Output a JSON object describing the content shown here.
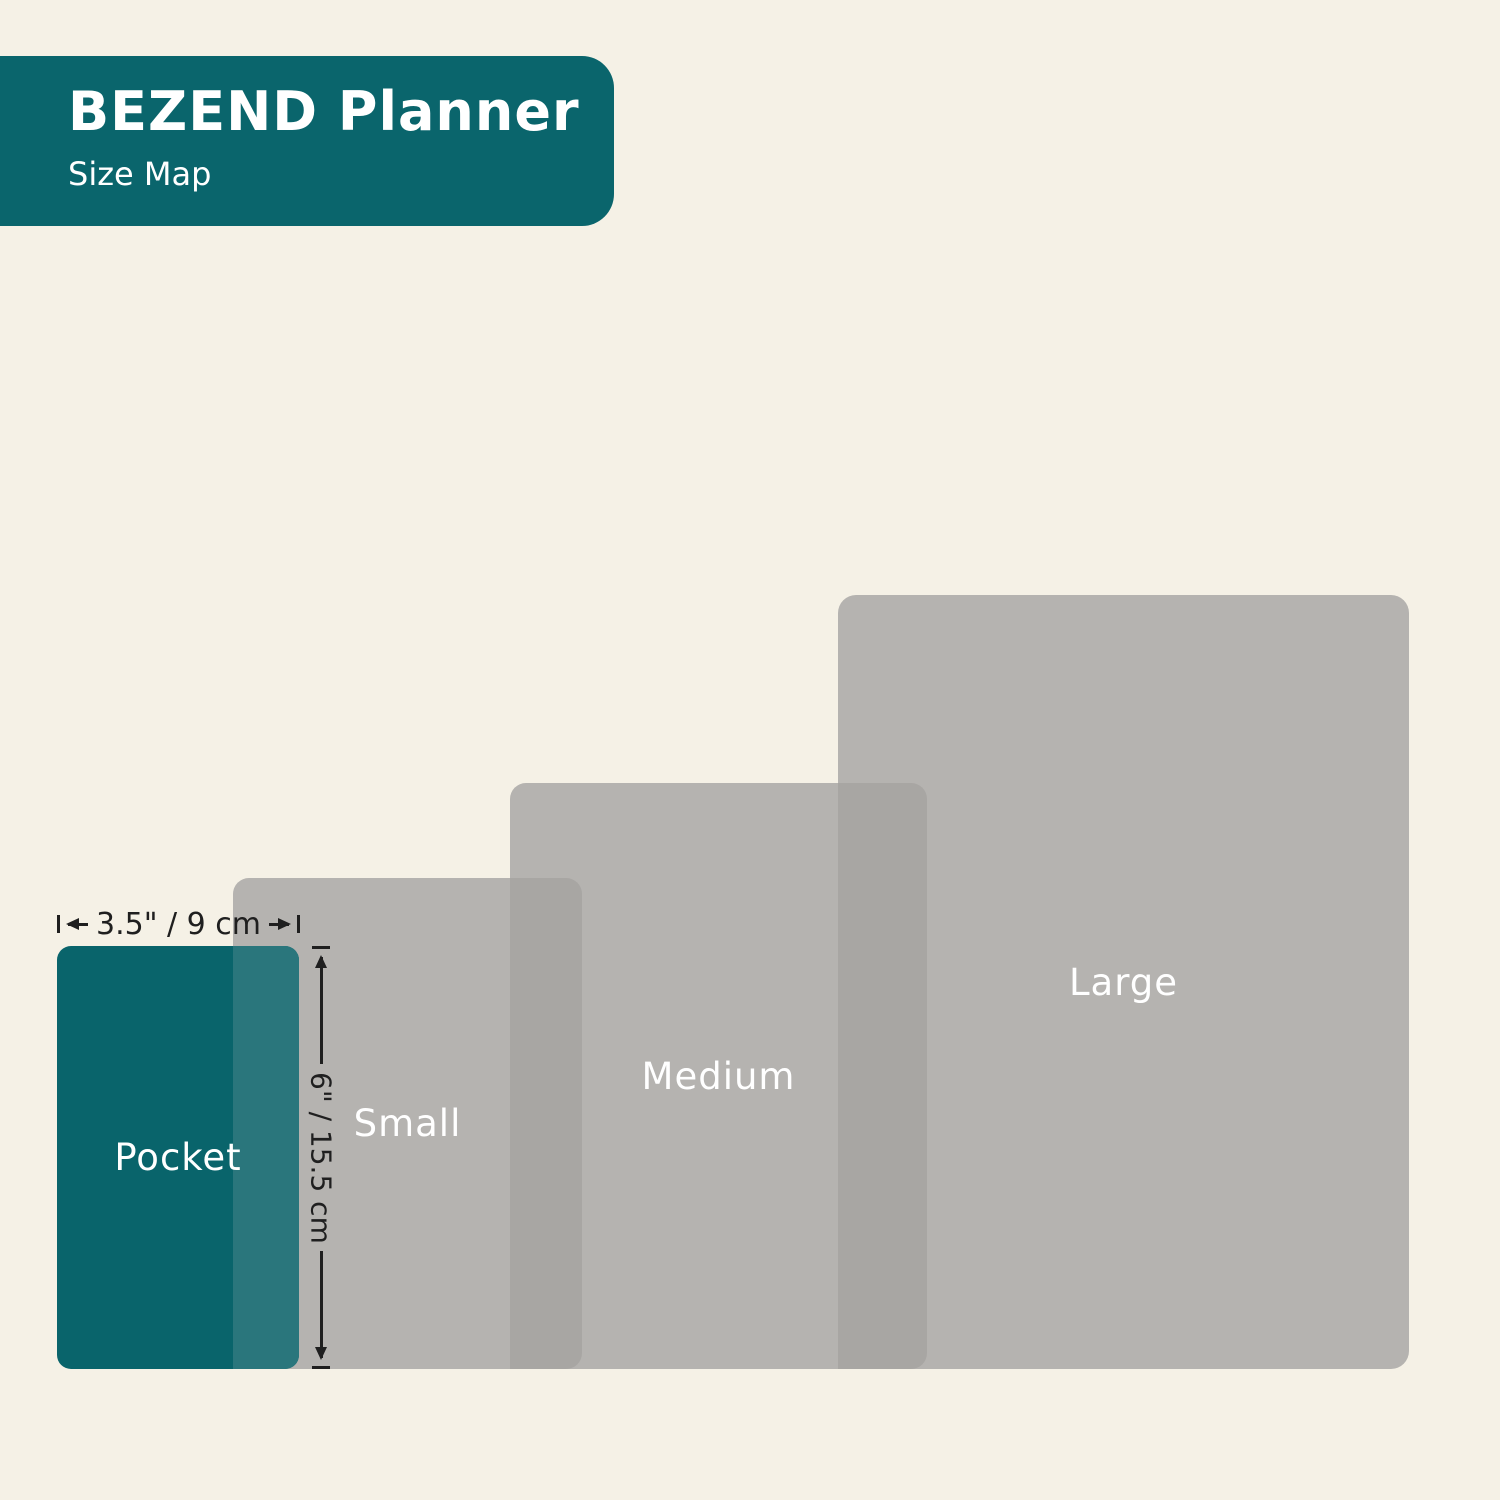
{
  "header": {
    "title": "BEZEND Planner",
    "subtitle": "Size Map"
  },
  "sizes": [
    {
      "id": "pocket",
      "label": "Pocket",
      "width_label": "3.5\" / 9 cm",
      "height_label": "6\" / 15.5 cm"
    },
    {
      "id": "small",
      "label": "Small"
    },
    {
      "id": "medium",
      "label": "Medium"
    },
    {
      "id": "large",
      "label": "Large"
    }
  ],
  "colors": {
    "background": "#F5F1E6",
    "header_teal": "#0A656C",
    "pocket_teal": "#09646B",
    "pocket_overlap_teal": "#2A767C",
    "size_gray": "#B5B3B0",
    "overlap_gray": "#A8A6A3",
    "dimension_line": "#1F1F1F",
    "label_text": "#FFFFFF"
  }
}
